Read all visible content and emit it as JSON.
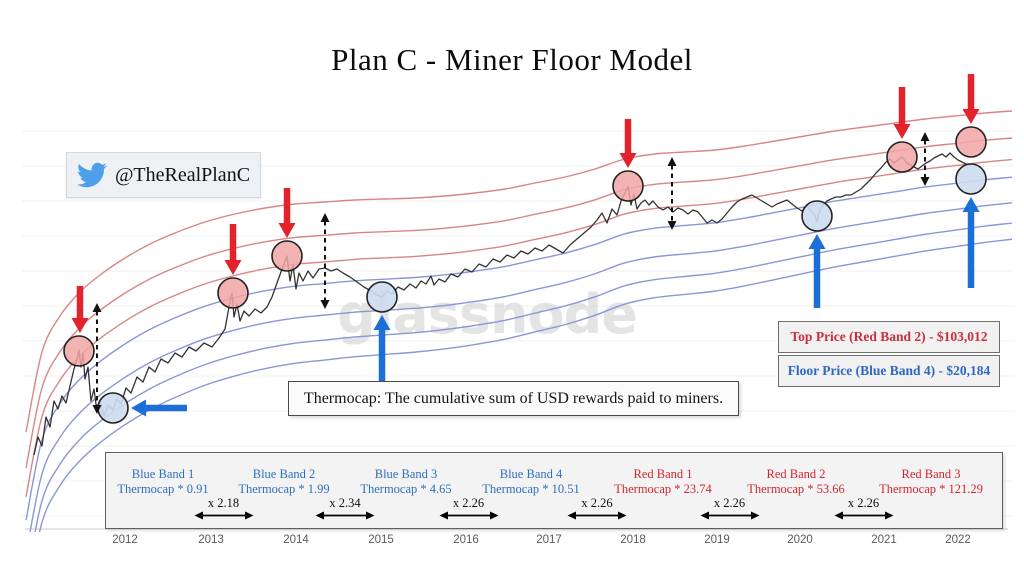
{
  "page": {
    "title": "Plan C - Miner Floor Model"
  },
  "twitter_badge": {
    "handle": "@TheRealPlanC",
    "bird_color": "#4d9fea"
  },
  "watermark_text": "glassnode",
  "note_box": {
    "text": "Thermocap: The cumulative sum of USD rewards paid to miners."
  },
  "price_boxes": {
    "top": {
      "label": "Top Price (Red Band 2) - $103,012",
      "color": "#c9303c"
    },
    "floor": {
      "label": "Floor Price (Blue Band 4) - $20,184",
      "color": "#2f68c0"
    }
  },
  "chart_data": {
    "type": "line",
    "title": "Plan C - Miner Floor Model",
    "description": "BTC price (unlabeled log scale) with 7 Thermocap-multiple bands; red circles mark cycle tops, blue circles mark cycle floors.",
    "x_ticks": [
      {
        "label": "2012",
        "x": 125
      },
      {
        "label": "2013",
        "x": 211
      },
      {
        "label": "2014",
        "x": 296
      },
      {
        "label": "2015",
        "x": 381
      },
      {
        "label": "2016",
        "x": 466
      },
      {
        "label": "2017",
        "x": 549
      },
      {
        "label": "2018",
        "x": 633
      },
      {
        "label": "2019",
        "x": 717
      },
      {
        "label": "2020",
        "x": 800
      },
      {
        "label": "2021",
        "x": 884
      },
      {
        "label": "2022",
        "x": 958
      }
    ],
    "bands": [
      {
        "name": "Red Band 3",
        "formula": "Thermocap * 121.29",
        "line_color": "#d98585",
        "label_color": "#d2262e",
        "factor": 0
      },
      {
        "name": "Red Band 2",
        "formula": "Thermocap * 53.66",
        "line_color": "#d98585",
        "label_color": "#d2262e",
        "factor": 1
      },
      {
        "name": "Red Band 1",
        "formula": "Thermocap * 23.74",
        "line_color": "#d98585",
        "label_color": "#d2262e",
        "factor": 1.8
      },
      {
        "name": "Blue Band 4",
        "formula": "Thermocap * 10.51",
        "line_color": "#8a96d8",
        "label_color": "#2e6fc2",
        "factor": 2.45
      },
      {
        "name": "Blue Band 3",
        "formula": "Thermocap * 4.65",
        "line_color": "#8a96d8",
        "label_color": "#2e6fc2",
        "factor": 3.4
      },
      {
        "name": "Blue Band 2",
        "formula": "Thermocap * 1.99",
        "line_color": "#8a96d8",
        "label_color": "#2e6fc2",
        "factor": 4.15
      },
      {
        "name": "Blue Band 1",
        "formula": "Thermocap * 0.91",
        "line_color": "#8a96d8",
        "label_color": "#2e6fc2",
        "factor": 4.75
      }
    ],
    "band_gaps": [
      "x 2.18",
      "x 2.34",
      "x 2.26",
      "x 2.26",
      "x 2.26",
      "x 2.26"
    ],
    "base_band_path": [
      [
        26,
        432
      ],
      [
        42,
        352
      ],
      [
        60,
        316
      ],
      [
        80,
        292
      ],
      [
        100,
        275
      ],
      [
        125,
        258
      ],
      [
        150,
        244
      ],
      [
        175,
        233
      ],
      [
        205,
        222
      ],
      [
        235,
        214
      ],
      [
        265,
        208
      ],
      [
        295,
        204
      ],
      [
        325,
        202
      ],
      [
        355,
        200
      ],
      [
        385,
        199
      ],
      [
        415,
        198
      ],
      [
        445,
        196
      ],
      [
        475,
        193
      ],
      [
        505,
        189
      ],
      [
        535,
        183
      ],
      [
        565,
        177
      ],
      [
        595,
        169
      ],
      [
        625,
        159
      ],
      [
        655,
        154
      ],
      [
        685,
        152
      ],
      [
        715,
        150
      ],
      [
        745,
        146
      ],
      [
        775,
        141
      ],
      [
        805,
        136
      ],
      [
        835,
        131
      ],
      [
        865,
        127
      ],
      [
        895,
        123
      ],
      [
        925,
        119
      ],
      [
        955,
        116
      ],
      [
        985,
        113
      ],
      [
        1012,
        111
      ]
    ],
    "price_path": [
      [
        34,
        455
      ],
      [
        38,
        437
      ],
      [
        42,
        446
      ],
      [
        46,
        417
      ],
      [
        50,
        427
      ],
      [
        54,
        401
      ],
      [
        58,
        409
      ],
      [
        62,
        396
      ],
      [
        66,
        403
      ],
      [
        70,
        386
      ],
      [
        74,
        369
      ],
      [
        77,
        359
      ],
      [
        79,
        350
      ],
      [
        81,
        367
      ],
      [
        83,
        353
      ],
      [
        85,
        379
      ],
      [
        88,
        367
      ],
      [
        91,
        401
      ],
      [
        94,
        389
      ],
      [
        97,
        412
      ],
      [
        100,
        401
      ],
      [
        104,
        416
      ],
      [
        108,
        405
      ],
      [
        113,
        410
      ],
      [
        117,
        399
      ],
      [
        121,
        404
      ],
      [
        126,
        388
      ],
      [
        131,
        393
      ],
      [
        137,
        377
      ],
      [
        143,
        382
      ],
      [
        149,
        367
      ],
      [
        155,
        372
      ],
      [
        161,
        359
      ],
      [
        168,
        363
      ],
      [
        175,
        353
      ],
      [
        182,
        357
      ],
      [
        189,
        347
      ],
      [
        196,
        351
      ],
      [
        204,
        343
      ],
      [
        212,
        347
      ],
      [
        219,
        338
      ],
      [
        225,
        329
      ],
      [
        229,
        307
      ],
      [
        232,
        293
      ],
      [
        234,
        317
      ],
      [
        237,
        304
      ],
      [
        240,
        321
      ],
      [
        244,
        311
      ],
      [
        249,
        316
      ],
      [
        255,
        309
      ],
      [
        261,
        313
      ],
      [
        267,
        307
      ],
      [
        272,
        297
      ],
      [
        277,
        283
      ],
      [
        282,
        269
      ],
      [
        287,
        256
      ],
      [
        290,
        281
      ],
      [
        293,
        265
      ],
      [
        296,
        289
      ],
      [
        299,
        273
      ],
      [
        303,
        281
      ],
      [
        308,
        271
      ],
      [
        313,
        278
      ],
      [
        319,
        269
      ],
      [
        325,
        268
      ],
      [
        331,
        271
      ],
      [
        337,
        269
      ],
      [
        343,
        273
      ],
      [
        350,
        277
      ],
      [
        357,
        282
      ],
      [
        364,
        287
      ],
      [
        371,
        291
      ],
      [
        377,
        295
      ],
      [
        382,
        297
      ],
      [
        387,
        291
      ],
      [
        392,
        294
      ],
      [
        398,
        287
      ],
      [
        404,
        290
      ],
      [
        410,
        284
      ],
      [
        416,
        288
      ],
      [
        421,
        281
      ],
      [
        426,
        284
      ],
      [
        431,
        276
      ],
      [
        434,
        285
      ],
      [
        439,
        279
      ],
      [
        445,
        282
      ],
      [
        451,
        274
      ],
      [
        458,
        277
      ],
      [
        465,
        269
      ],
      [
        472,
        272
      ],
      [
        479,
        264
      ],
      [
        486,
        267
      ],
      [
        493,
        259
      ],
      [
        500,
        262
      ],
      [
        507,
        255
      ],
      [
        514,
        258
      ],
      [
        521,
        251
      ],
      [
        528,
        254
      ],
      [
        535,
        248
      ],
      [
        542,
        251
      ],
      [
        549,
        245
      ],
      [
        556,
        249
      ],
      [
        563,
        253
      ],
      [
        570,
        245
      ],
      [
        577,
        239
      ],
      [
        584,
        233
      ],
      [
        591,
        227
      ],
      [
        597,
        220
      ],
      [
        602,
        213
      ],
      [
        607,
        223
      ],
      [
        612,
        209
      ],
      [
        617,
        215
      ],
      [
        621,
        201
      ],
      [
        625,
        193
      ],
      [
        628,
        186
      ],
      [
        631,
        205
      ],
      [
        634,
        194
      ],
      [
        637,
        209
      ],
      [
        641,
        203
      ],
      [
        645,
        200
      ],
      [
        649,
        205
      ],
      [
        653,
        201
      ],
      [
        658,
        207
      ],
      [
        663,
        210
      ],
      [
        668,
        207
      ],
      [
        673,
        212
      ],
      [
        678,
        208
      ],
      [
        683,
        210
      ],
      [
        688,
        214
      ],
      [
        693,
        210
      ],
      [
        698,
        212
      ],
      [
        703,
        218
      ],
      [
        707,
        223
      ],
      [
        712,
        220
      ],
      [
        717,
        223
      ],
      [
        722,
        219
      ],
      [
        727,
        213
      ],
      [
        732,
        207
      ],
      [
        737,
        202
      ],
      [
        742,
        199
      ],
      [
        747,
        197
      ],
      [
        752,
        195
      ],
      [
        757,
        198
      ],
      [
        762,
        201
      ],
      [
        767,
        204
      ],
      [
        772,
        207
      ],
      [
        777,
        204
      ],
      [
        782,
        202
      ],
      [
        787,
        200
      ],
      [
        792,
        204
      ],
      [
        797,
        208
      ],
      [
        802,
        211
      ],
      [
        807,
        206
      ],
      [
        812,
        212
      ],
      [
        815,
        215
      ],
      [
        817,
        222
      ],
      [
        819,
        213
      ],
      [
        823,
        205
      ],
      [
        827,
        201
      ],
      [
        831,
        199
      ],
      [
        836,
        197
      ],
      [
        841,
        197
      ],
      [
        846,
        195
      ],
      [
        851,
        195
      ],
      [
        856,
        192
      ],
      [
        861,
        189
      ],
      [
        866,
        184
      ],
      [
        871,
        179
      ],
      [
        876,
        173
      ],
      [
        881,
        168
      ],
      [
        886,
        162
      ],
      [
        890,
        159
      ],
      [
        894,
        163
      ],
      [
        898,
        160
      ],
      [
        902,
        157
      ],
      [
        906,
        162
      ],
      [
        910,
        165
      ],
      [
        914,
        167
      ],
      [
        918,
        169
      ],
      [
        922,
        166
      ],
      [
        926,
        163
      ],
      [
        930,
        161
      ],
      [
        934,
        158
      ],
      [
        938,
        156
      ],
      [
        942,
        154
      ],
      [
        946,
        157
      ],
      [
        950,
        153
      ],
      [
        954,
        157
      ],
      [
        958,
        160
      ],
      [
        962,
        162
      ],
      [
        966,
        164
      ],
      [
        970,
        165
      ]
    ],
    "price_color": "#333333",
    "annotations": {
      "top_markers": {
        "fill": "rgba(242,166,166,0.85)",
        "points": [
          [
            79,
            351
          ],
          [
            233,
            293
          ],
          [
            287,
            256
          ],
          [
            628,
            186
          ],
          [
            902,
            157
          ],
          [
            971,
            142
          ]
        ]
      },
      "bottom_markers": {
        "fill": "rgba(205,220,240,0.9)",
        "points": [
          [
            113,
            408
          ],
          [
            382,
            297
          ],
          [
            817,
            216
          ],
          [
            971,
            179
          ]
        ]
      },
      "red_arrows_down": {
        "color": "#e3232b",
        "list": [
          {
            "x": 80,
            "y1": 286,
            "y2": 333
          },
          {
            "x": 233,
            "y1": 224,
            "y2": 275
          },
          {
            "x": 287,
            "y1": 188,
            "y2": 238
          },
          {
            "x": 628,
            "y1": 119,
            "y2": 168
          },
          {
            "x": 902,
            "y1": 87,
            "y2": 139
          },
          {
            "x": 971,
            "y1": 74,
            "y2": 124
          }
        ]
      },
      "blue_arrows_up": {
        "color": "#1b6fd6",
        "list": [
          {
            "x": 382,
            "y1": 390,
            "y2": 315
          },
          {
            "x": 817,
            "y1": 308,
            "y2": 234
          },
          {
            "x": 971,
            "y1": 288,
            "y2": 197
          }
        ]
      },
      "blue_arrow_left": {
        "color": "#1b6fd6",
        "y": 408,
        "x1": 187,
        "x2": 131
      },
      "dashed_spans": {
        "color": "#111111",
        "list": [
          {
            "x": 97,
            "y1": 303,
            "y2": 414
          },
          {
            "x": 325,
            "y1": 213,
            "y2": 309
          },
          {
            "x": 672,
            "y1": 157,
            "y2": 230
          },
          {
            "x": 925,
            "y1": 132,
            "y2": 186
          }
        ]
      }
    }
  }
}
